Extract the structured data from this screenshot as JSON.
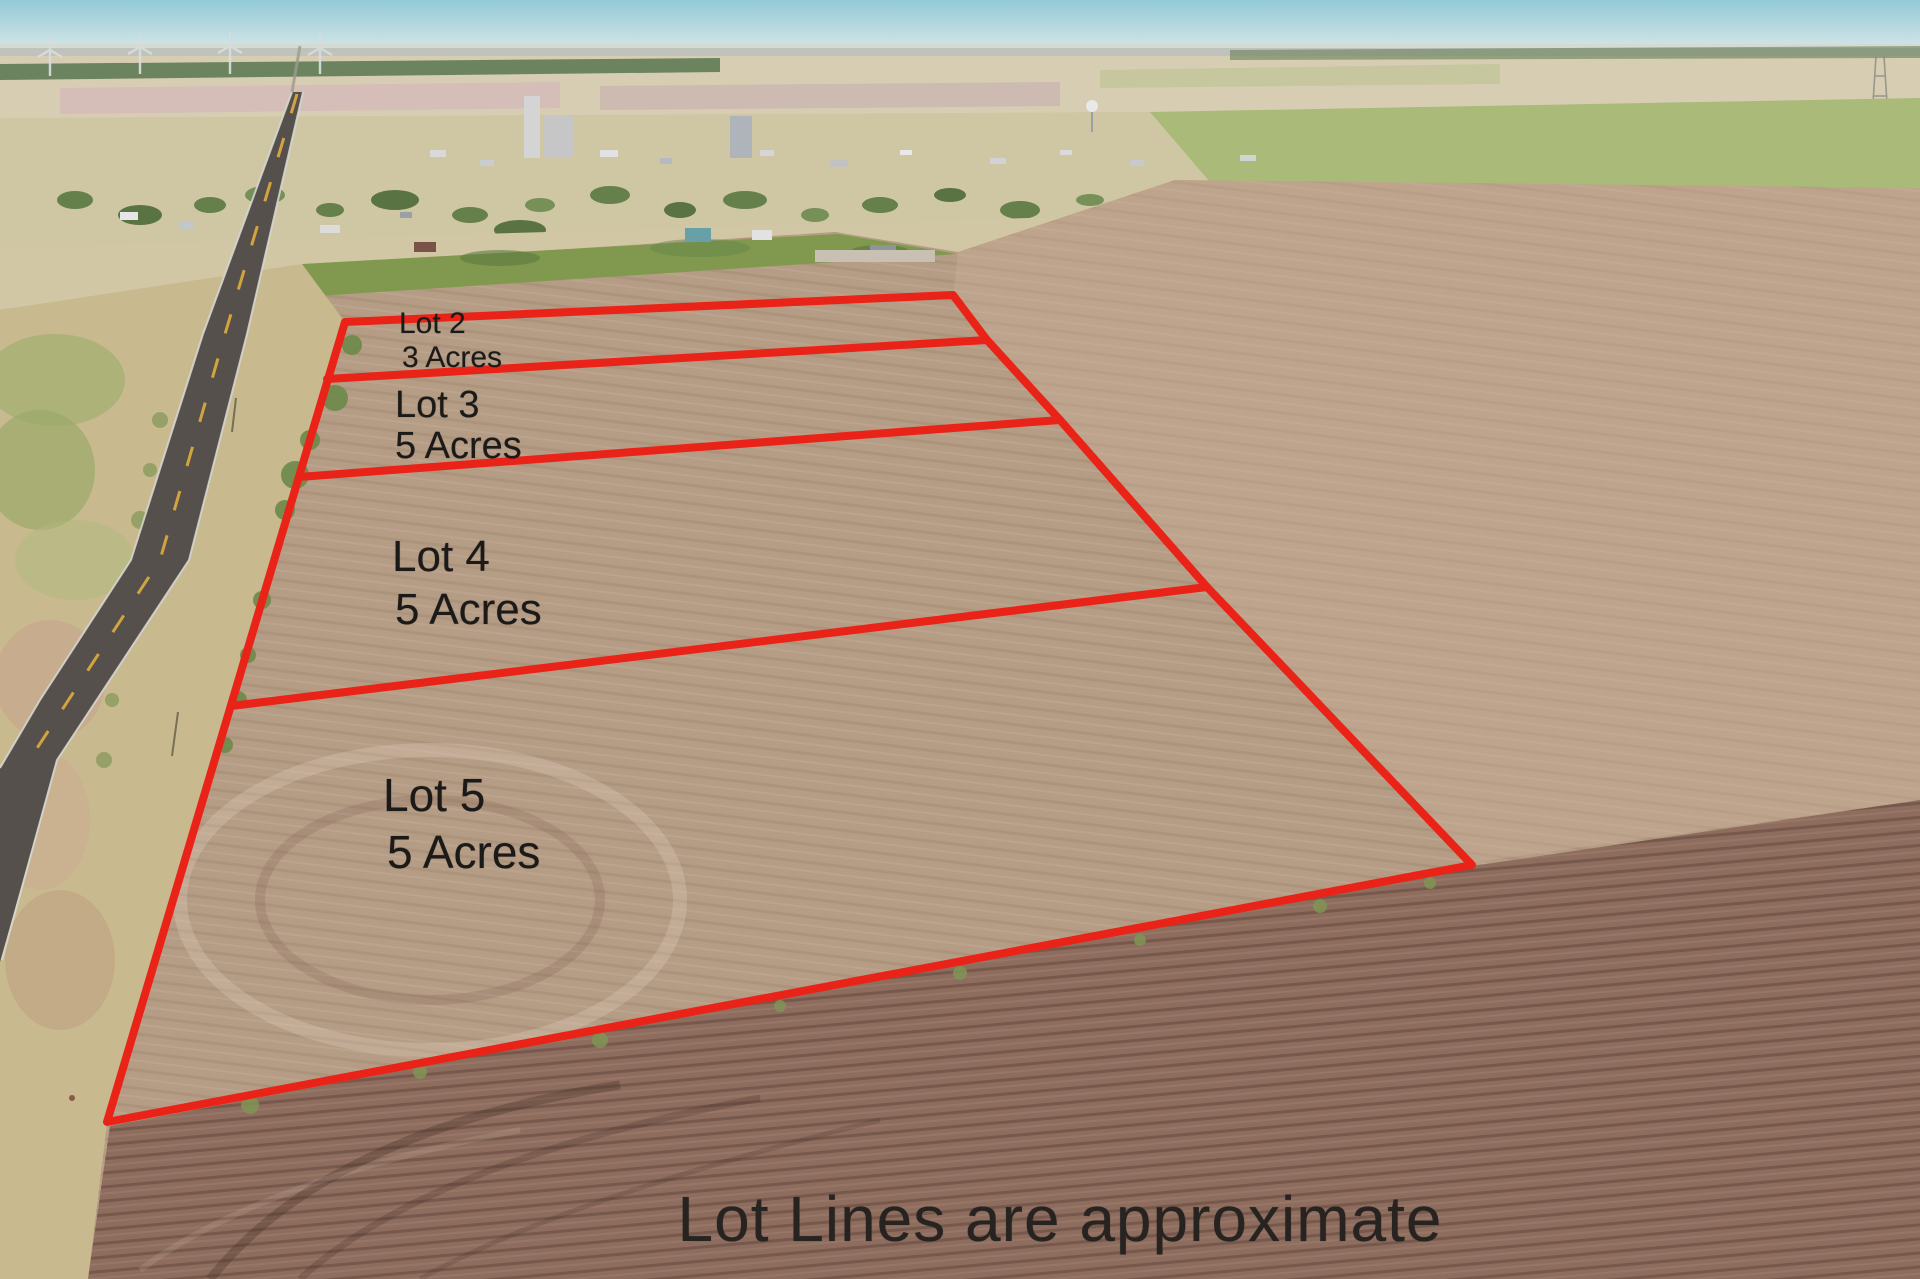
{
  "image": {
    "kind": "aerial drone photo of subdivided farmland for sale",
    "disclaimer": "Lot Lines are approximate"
  },
  "lots": [
    {
      "id": "lot-2",
      "name": "Lot 2",
      "size": "3 Acres"
    },
    {
      "id": "lot-3",
      "name": "Lot 3",
      "size": "5 Acres"
    },
    {
      "id": "lot-4",
      "name": "Lot 4",
      "size": "5 Acres"
    },
    {
      "id": "lot-5",
      "name": "Lot 5",
      "size": "5 Acres"
    }
  ],
  "colors": {
    "lot_line": "#ea2318",
    "label_text": "#1c1a18",
    "disclaimer_text": "#272320",
    "sky_top": "#93cad7",
    "sky_horizon": "#d2e5e7",
    "field_tan": "#b59c85",
    "field_dark_brown": "#8e6d5e",
    "green_strip": "#80994f",
    "road_asphalt": "#55504b",
    "road_center_dash": "#d8a93f"
  }
}
